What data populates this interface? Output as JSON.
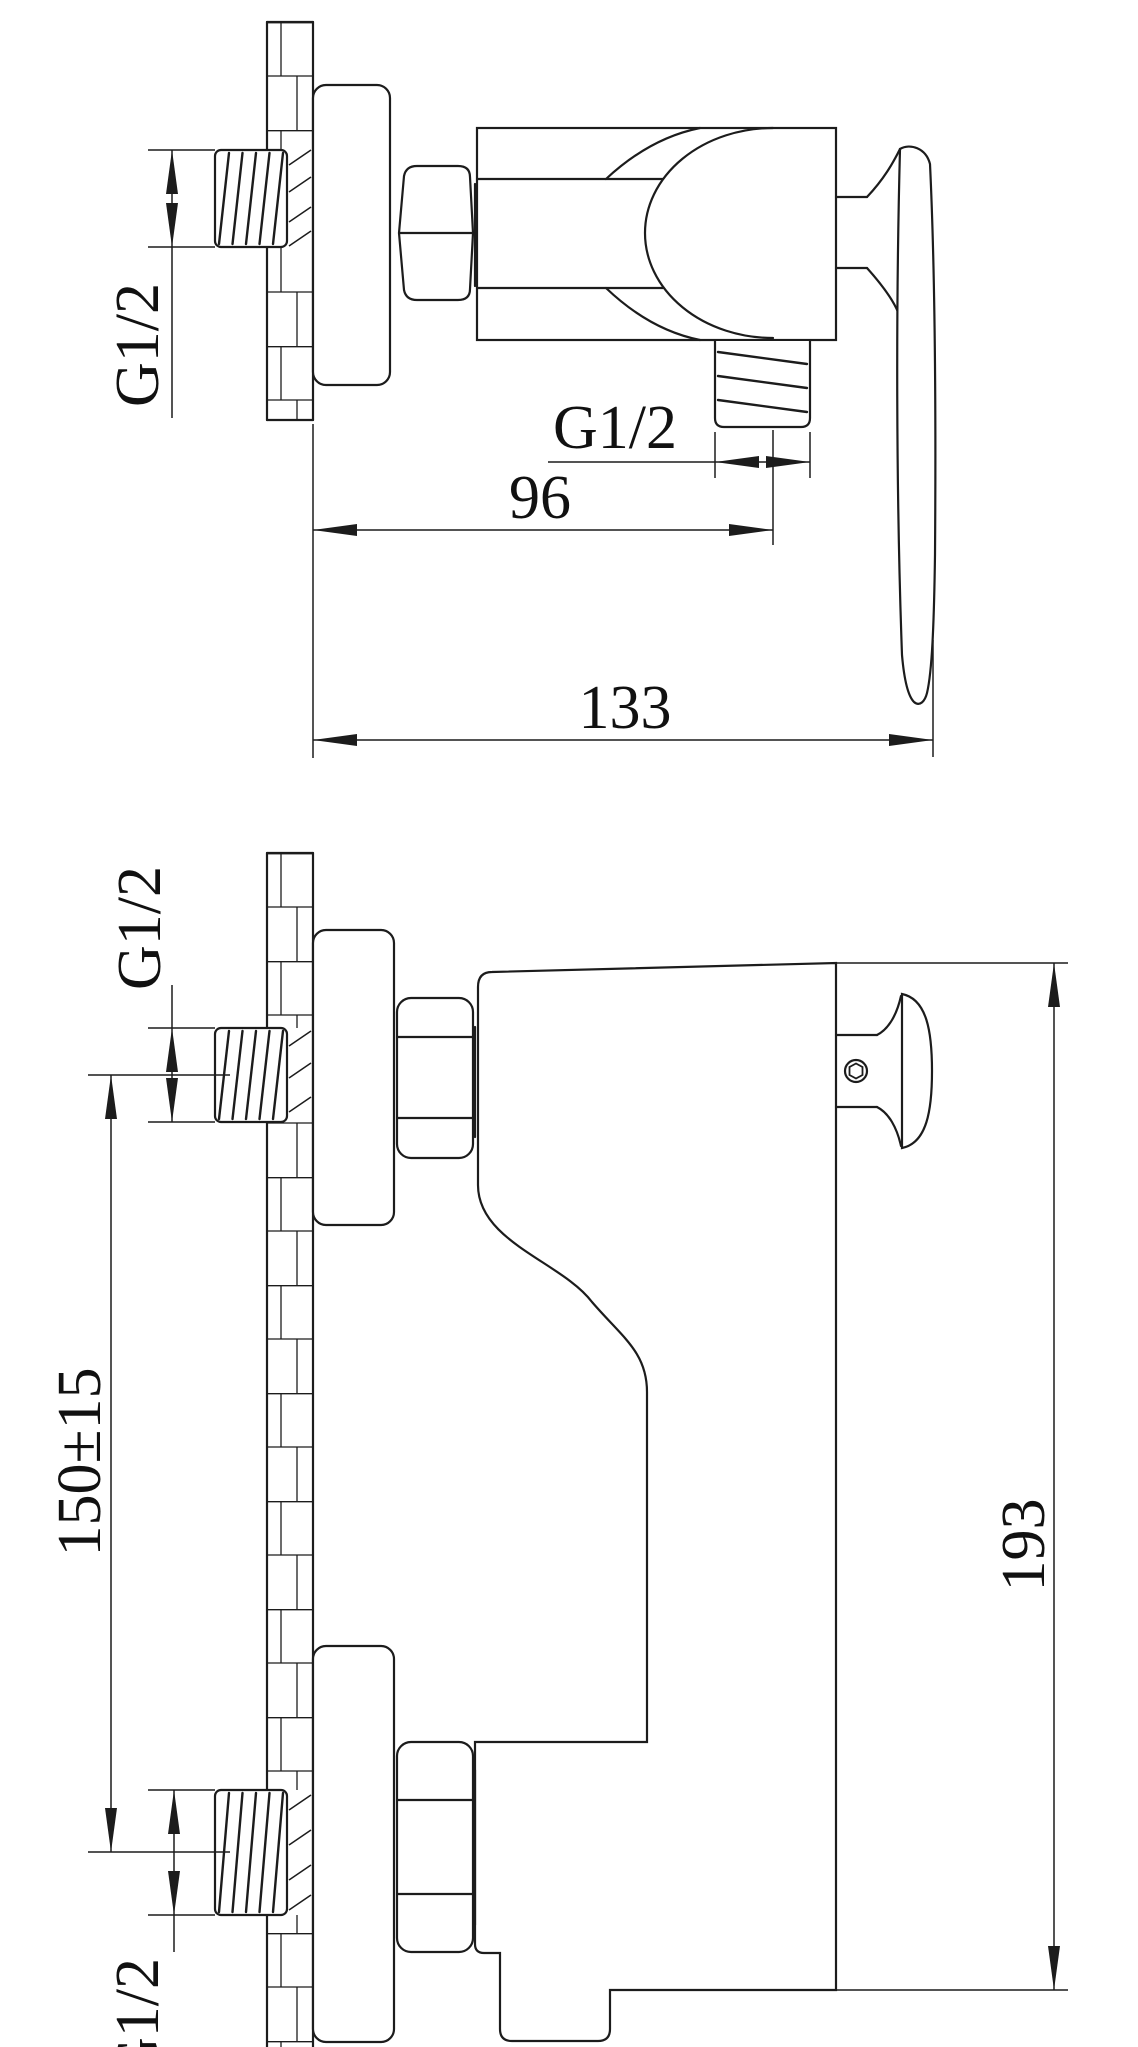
{
  "sheet": {
    "background": "#ffffff",
    "ink": "#1c1c1c"
  },
  "top_view": {
    "inlet_thread_label": "G1/2",
    "outlet_thread_label": "G1/2",
    "outlet_offset_dim": "96",
    "overall_depth_dim": "133"
  },
  "side_view": {
    "upper_inlet_thread_label": "G1/2",
    "lower_inlet_thread_label": "G1/2",
    "inlet_spacing_dim": "150±15",
    "overall_height_dim": "193"
  }
}
